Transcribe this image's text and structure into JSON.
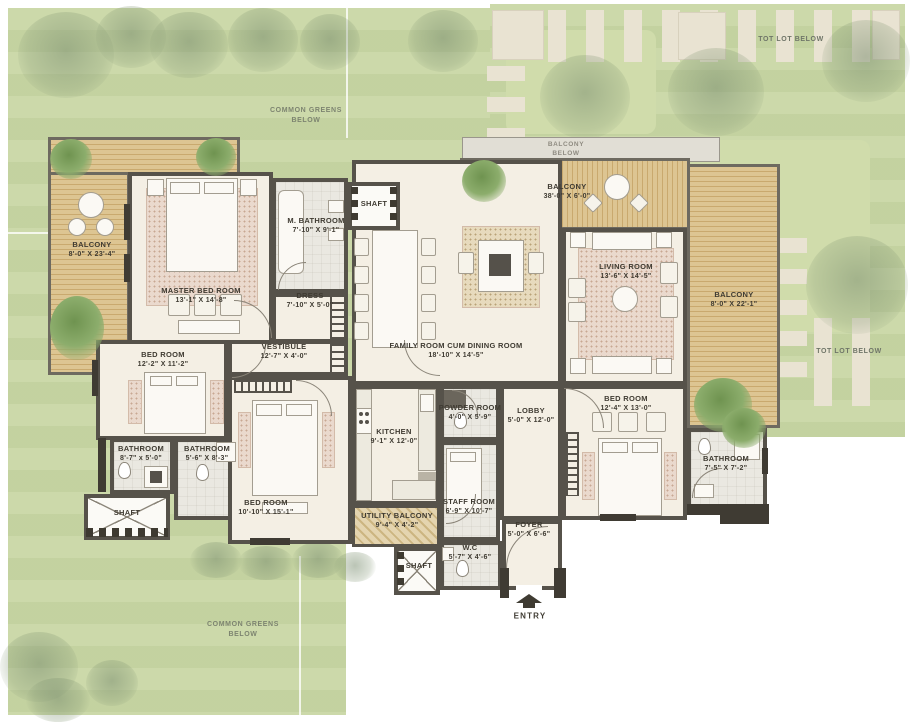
{
  "palette": {
    "lawn": "#c9d7a5",
    "lawn_light": "#d0dcab",
    "paving": "#e9e3d2",
    "wood": "#ddc592",
    "wood_dark": "#c9a96e",
    "wall": "#56524a",
    "floor": "#f4efe4",
    "tile": "#eae8e1",
    "rug": "#ead9cd",
    "band": "#e1ded5",
    "text_dark": "#3f3b32",
    "text_greens": "#7d8470"
  },
  "site": {
    "commonGreensTop": {
      "line1": "COMMON GREENS",
      "line2": "BELOW"
    },
    "commonGreensBottom": {
      "line1": "COMMON GREENS",
      "line2": "BELOW"
    },
    "totLotTop": "TOT LOT BELOW",
    "totLotRight": "TOT LOT BELOW",
    "balconyBelow": {
      "line1": "BALCONY",
      "line2": "BELOW"
    },
    "entry": "ENTRY"
  },
  "rooms": {
    "balconyLeft": {
      "name": "BALCONY",
      "dims": "8'-0\" X 23'-4\""
    },
    "master": {
      "name": "MASTER BED ROOM",
      "dims": "13'-1\" X 14'-8\""
    },
    "mbath": {
      "name": "M. BATHROOM",
      "dims": "7'-10\" X 9'-1\""
    },
    "shaftTop": {
      "name": "SHAFT",
      "dims": ""
    },
    "dress": {
      "name": "DRESS",
      "dims": "7'-10\" X 5'-0\""
    },
    "vestibule": {
      "name": "VESTIBULE",
      "dims": "12'-7\" X 4'-0\""
    },
    "family": {
      "name": "FAMILY ROOM CUM DINING ROOM",
      "dims": "18'-10\" X 14'-5\""
    },
    "balconyTop": {
      "name": "BALCONY",
      "dims": "38'-0\" X 6'-0\""
    },
    "living": {
      "name": "LIVING ROOM",
      "dims": "13'-6\" X 14'-5\""
    },
    "balconyRight": {
      "name": "BALCONY",
      "dims": "8'-0\" X 22'-1\""
    },
    "bedLeft": {
      "name": "BED ROOM",
      "dims": "12'-2\" X 11'-2\""
    },
    "bathA": {
      "name": "BATHROOM",
      "dims": "8'-7\" x 5'-0\""
    },
    "bathB": {
      "name": "BATHROOM",
      "dims": "5'-6\" X 8'-3\""
    },
    "shaftLeft": {
      "name": "SHAFT",
      "dims": ""
    },
    "bedBL": {
      "name": "BED ROOM",
      "dims": "10'-10\" X 15'-1\""
    },
    "kitchen": {
      "name": "KITCHEN",
      "dims": "9'-1\" X 12'-0\""
    },
    "powder": {
      "name": "POWDER ROOM",
      "dims": "4'-0\" X 5'-9\""
    },
    "lobby": {
      "name": "LOBBY",
      "dims": "5'-0\" X 12'-0\""
    },
    "staff": {
      "name": "STAFF ROOM",
      "dims": "6'-9\" X 10'-7\""
    },
    "utility": {
      "name": "UTILITY BALCONY",
      "dims": "9'-4\" X 4'-2\""
    },
    "wc": {
      "name": "W.C",
      "dims": "5'-7\" X 4'-6\""
    },
    "shaftBottom": {
      "name": "SHAFT",
      "dims": ""
    },
    "foyer": {
      "name": "FOYER",
      "dims": "5'-0\" X 6'-6\""
    },
    "bedRight": {
      "name": "BED ROOM",
      "dims": "12'-4\" X 13'-0\""
    },
    "bathRight": {
      "name": "BATHROOM",
      "dims": "7'-5\" X 7'-2\""
    }
  }
}
